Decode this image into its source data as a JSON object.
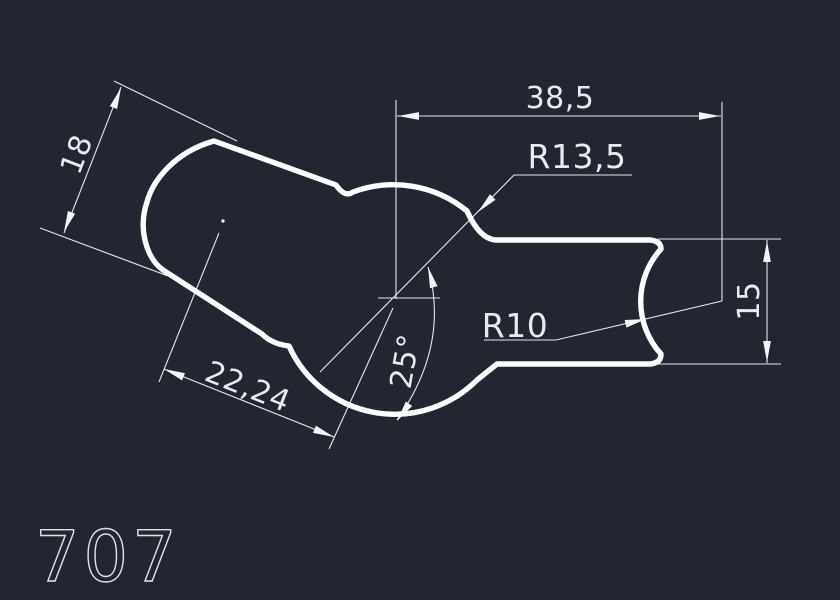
{
  "drawing": {
    "part_label": "707",
    "dimensions": {
      "lobe_width": "18",
      "overall_length": "38,5",
      "large_radius": "R13,5",
      "small_radius": "R10",
      "profile_height": "15",
      "center_distance": "22,24",
      "angle": "25°"
    },
    "colors": {
      "background": "#222631",
      "geometry": "#fdfdfd",
      "annotation": "#e3e7ee"
    }
  }
}
